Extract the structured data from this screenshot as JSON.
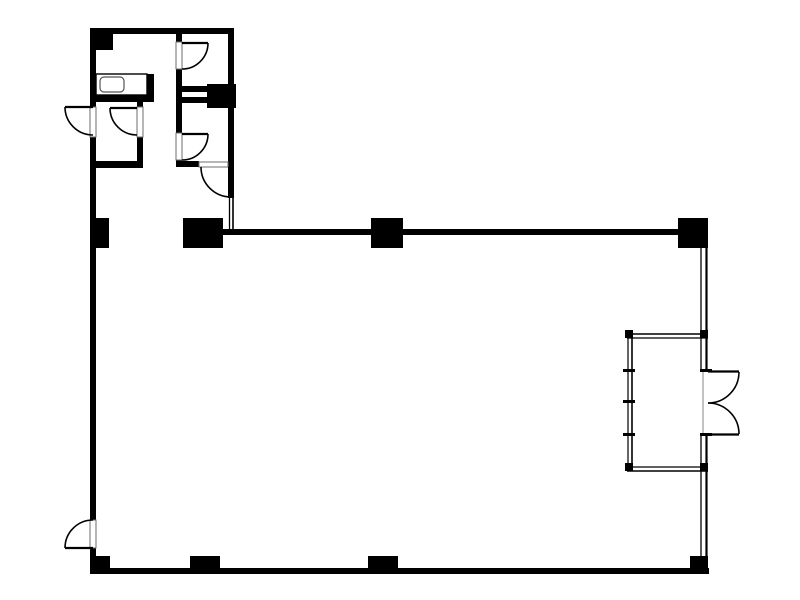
{
  "canvas": {
    "width": 800,
    "height": 600,
    "background_color": "#ffffff",
    "wall_color": "#000000",
    "line_color": "#000000",
    "frame_border_color": "#6e6e6e",
    "threshold_color": "#9a9a9a",
    "sink_border_color": "#555555"
  },
  "floorplan": {
    "description_labels": [],
    "walls": [
      {
        "name": "top-wall",
        "x": 90,
        "y": 28,
        "w": 144,
        "h": 6
      },
      {
        "name": "left-wall",
        "x": 90,
        "y": 28,
        "w": 6,
        "h": 546
      },
      {
        "name": "upper-section-right-wall",
        "x": 228,
        "y": 28,
        "w": 6,
        "h": 140
      },
      {
        "name": "rooms-middle-wall",
        "x": 176,
        "y": 33,
        "w": 6,
        "h": 134
      },
      {
        "name": "room-a-bottom-wall",
        "x": 90,
        "y": 95,
        "w": 64,
        "h": 7
      },
      {
        "name": "counter-end-wall",
        "x": 147,
        "y": 74,
        "w": 7,
        "h": 28
      },
      {
        "name": "room-b-right-wall",
        "x": 137,
        "y": 102,
        "w": 6,
        "h": 66
      },
      {
        "name": "room-b-bottom-wall",
        "x": 90,
        "y": 161,
        "w": 53,
        "h": 7
      },
      {
        "name": "room-divider-upper",
        "x": 176,
        "y": 86,
        "w": 31,
        "h": 6
      },
      {
        "name": "room-divider-lower",
        "x": 176,
        "y": 97,
        "w": 31,
        "h": 6
      },
      {
        "name": "room-e-bottom-wall",
        "x": 176,
        "y": 161,
        "w": 23,
        "h": 6
      },
      {
        "name": "main-hall-top-wall",
        "x": 203,
        "y": 229,
        "w": 492,
        "h": 6
      },
      {
        "name": "bottom-wall",
        "x": 90,
        "y": 568,
        "w": 619,
        "h": 6
      }
    ],
    "columns": [
      {
        "name": "column-top-left-corner",
        "x": 94,
        "y": 33,
        "w": 19,
        "h": 17
      },
      {
        "name": "column-room-divider",
        "x": 207,
        "y": 84,
        "w": 29,
        "h": 24
      },
      {
        "name": "column-left-wall-mid",
        "x": 92,
        "y": 218,
        "w": 17,
        "h": 30
      },
      {
        "name": "column-hall-corner",
        "x": 183,
        "y": 218,
        "w": 40,
        "h": 30
      },
      {
        "name": "column-hall-top-mid",
        "x": 371,
        "y": 218,
        "w": 32,
        "h": 30
      },
      {
        "name": "column-hall-top-right",
        "x": 678,
        "y": 218,
        "w": 30,
        "h": 30
      },
      {
        "name": "column-bottom-left",
        "x": 93,
        "y": 556,
        "w": 17,
        "h": 17
      },
      {
        "name": "column-bottom-mid-left",
        "x": 190,
        "y": 556,
        "w": 30,
        "h": 17
      },
      {
        "name": "column-bottom-mid",
        "x": 368,
        "y": 556,
        "w": 30,
        "h": 17
      },
      {
        "name": "column-bottom-right",
        "x": 690,
        "y": 556,
        "w": 18,
        "h": 17
      }
    ],
    "door_frames": [
      {
        "name": "door-frame-room-d",
        "x": 176,
        "y": 42,
        "w": 6,
        "h": 27
      },
      {
        "name": "door-frame-room-b-inner",
        "x": 137,
        "y": 107,
        "w": 6,
        "h": 30
      },
      {
        "name": "door-frame-exterior-upper-left",
        "x": 90,
        "y": 107,
        "w": 6,
        "h": 30
      },
      {
        "name": "door-frame-room-e",
        "x": 176,
        "y": 133,
        "w": 6,
        "h": 27
      },
      {
        "name": "door-frame-room-e-south",
        "x": 199,
        "y": 162,
        "w": 29,
        "h": 5
      },
      {
        "name": "door-frame-exterior-lower-left",
        "x": 90,
        "y": 520,
        "w": 6,
        "h": 28
      }
    ],
    "door_leaves": [
      {
        "name": "door-leaf-room-d",
        "x1": 182,
        "y1": 43,
        "x2": 208,
        "y2": 43
      },
      {
        "name": "door-leaf-room-b-inner",
        "x1": 137,
        "y1": 108,
        "x2": 110,
        "y2": 108
      },
      {
        "name": "door-leaf-exterior-upper-left",
        "x1": 93,
        "y1": 107,
        "x2": 65,
        "y2": 107
      },
      {
        "name": "door-leaf-room-e",
        "x1": 182,
        "y1": 134,
        "x2": 208,
        "y2": 134
      },
      {
        "name": "door-leaf-exterior-lower-left",
        "x1": 93,
        "y1": 548,
        "x2": 65,
        "y2": 548
      },
      {
        "name": "door-leaf-entry-north",
        "x1": 708,
        "y1": 371.5,
        "x2": 739,
        "y2": 371.5
      },
      {
        "name": "door-leaf-entry-south",
        "x1": 708,
        "y1": 434.5,
        "x2": 739,
        "y2": 434.5
      }
    ],
    "door_leaf_bars": [
      {
        "name": "door-leaf-room-e-south",
        "x": 228,
        "y": 167,
        "w": 6,
        "h": 31
      }
    ],
    "door_arcs": [
      {
        "name": "door-swing-room-d",
        "cx": 182,
        "cy": 43,
        "r": 26,
        "a1": 0,
        "a2": 90,
        "sweep": 1
      },
      {
        "name": "door-swing-room-b-inner",
        "cx": 137,
        "cy": 108,
        "r": 27,
        "a1": 180,
        "a2": 90,
        "sweep": 0
      },
      {
        "name": "door-swing-exterior-upper-left",
        "cx": 93,
        "cy": 107,
        "r": 28,
        "a1": 180,
        "a2": 90,
        "sweep": 0
      },
      {
        "name": "door-swing-room-e",
        "cx": 182,
        "cy": 134,
        "r": 26,
        "a1": 0,
        "a2": 90,
        "sweep": 1
      },
      {
        "name": "door-swing-room-e-south",
        "cx": 231,
        "cy": 167,
        "r": 30,
        "a1": 180,
        "a2": 90,
        "sweep": 0
      },
      {
        "name": "door-swing-exterior-lower-left",
        "cx": 93,
        "cy": 548,
        "r": 28,
        "a1": 180,
        "a2": 270,
        "sweep": 1
      },
      {
        "name": "door-swing-entry-north",
        "cx": 708,
        "cy": 372,
        "r": 31,
        "a1": 0,
        "a2": 90,
        "sweep": 1
      },
      {
        "name": "door-swing-entry-south",
        "cx": 708,
        "cy": 434,
        "r": 31,
        "a1": 0,
        "a2": 270,
        "sweep": 0
      }
    ],
    "thin_lines": [
      {
        "name": "jamb-line-inner",
        "x1": 229.5,
        "y1": 198,
        "x2": 229.5,
        "y2": 230,
        "w": 1.3
      },
      {
        "name": "jamb-line-outer",
        "x1": 233,
        "y1": 198,
        "x2": 233,
        "y2": 230,
        "w": 1.6
      },
      {
        "name": "right-wall-upper-inner",
        "x1": 701,
        "y1": 248,
        "x2": 701,
        "y2": 372,
        "w": 1.3
      },
      {
        "name": "right-wall-upper-outer",
        "x1": 706.5,
        "y1": 248,
        "x2": 706.5,
        "y2": 372,
        "w": 2.2
      },
      {
        "name": "right-wall-lower-inner",
        "x1": 701,
        "y1": 434,
        "x2": 701,
        "y2": 557,
        "w": 1.3
      },
      {
        "name": "right-wall-lower-outer",
        "x1": 706.5,
        "y1": 434,
        "x2": 706.5,
        "y2": 557,
        "w": 2.2
      },
      {
        "name": "vestibule-left-inner",
        "x1": 628,
        "y1": 334,
        "x2": 628,
        "y2": 471,
        "w": 1.2
      },
      {
        "name": "vestibule-left-outer",
        "x1": 632,
        "y1": 334,
        "x2": 632,
        "y2": 471,
        "w": 1.6
      },
      {
        "name": "vestibule-top-outer",
        "x1": 627,
        "y1": 334,
        "x2": 708,
        "y2": 334,
        "w": 1.6
      },
      {
        "name": "vestibule-top-inner",
        "x1": 627,
        "y1": 338,
        "x2": 708,
        "y2": 338,
        "w": 1.2
      },
      {
        "name": "vestibule-bottom-inner",
        "x1": 627,
        "y1": 467,
        "x2": 708,
        "y2": 467,
        "w": 1.2
      },
      {
        "name": "vestibule-bottom-outer",
        "x1": 627,
        "y1": 471,
        "x2": 708,
        "y2": 471,
        "w": 1.6
      }
    ],
    "threshold_lines": [
      {
        "name": "entry-door-threshold",
        "x1": 703,
        "y1": 372,
        "x2": 703,
        "y2": 434,
        "w": 1.2
      }
    ],
    "corner_posts": [
      {
        "name": "vestibule-post-nw",
        "x": 625,
        "y": 330,
        "w": 8,
        "h": 8
      },
      {
        "name": "vestibule-post-ne",
        "x": 700,
        "y": 330,
        "w": 8,
        "h": 8
      },
      {
        "name": "vestibule-post-sw",
        "x": 625,
        "y": 463,
        "w": 8,
        "h": 8
      },
      {
        "name": "vestibule-post-se",
        "x": 700,
        "y": 463,
        "w": 8,
        "h": 8
      }
    ],
    "mullion_ticks": [
      {
        "name": "mullion-tick-left-1",
        "x": 623,
        "y": 369,
        "w": 12,
        "h": 3
      },
      {
        "name": "mullion-tick-left-2",
        "x": 623,
        "y": 400,
        "w": 12,
        "h": 3
      },
      {
        "name": "mullion-tick-left-3",
        "x": 623,
        "y": 433,
        "w": 12,
        "h": 3
      },
      {
        "name": "mullion-tick-right-1",
        "x": 700,
        "y": 369,
        "w": 12,
        "h": 3
      },
      {
        "name": "mullion-tick-right-2",
        "x": 700,
        "y": 433,
        "w": 12,
        "h": 3
      }
    ],
    "fixtures": {
      "counter": {
        "name": "kitchen-counter",
        "x": 96,
        "y": 74,
        "w": 51,
        "h": 21
      },
      "sink": {
        "name": "kitchen-sink",
        "x": 100,
        "y": 77,
        "w": 24,
        "h": 15,
        "rx": 4
      }
    }
  }
}
